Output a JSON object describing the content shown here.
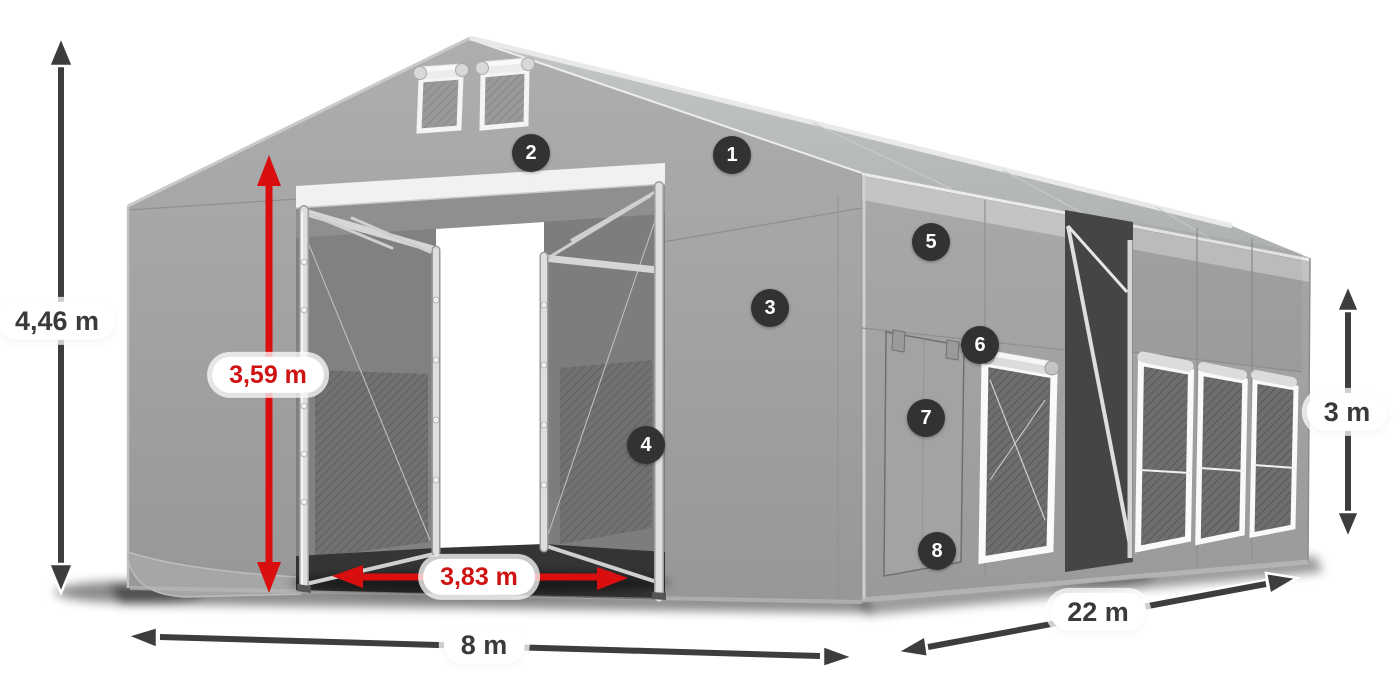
{
  "dimensions": {
    "total_height": {
      "value": "4,46 m"
    },
    "clear_height": {
      "value": "3,59 m"
    },
    "door_width": {
      "value": "3,83 m"
    },
    "front_width": {
      "value": "8 m"
    },
    "side_length": {
      "value": "22 m"
    },
    "wall_height": {
      "value": "3 m"
    }
  },
  "callouts": {
    "c1": {
      "number": "1"
    },
    "c2": {
      "number": "2"
    },
    "c3": {
      "number": "3"
    },
    "c4": {
      "number": "4"
    },
    "c5": {
      "number": "5"
    },
    "c6": {
      "number": "6"
    },
    "c7": {
      "number": "7"
    },
    "c8": {
      "number": "8"
    }
  },
  "colors": {
    "dimension_red": "#d90f0f",
    "dimension_dark": "#3d3d3d",
    "pill_background": "#ffffff",
    "pill_text_dark": "#3a3a3a",
    "badge_background": "#323232",
    "badge_text": "#ffffff",
    "tent_fabric": "#a2a2a2"
  }
}
